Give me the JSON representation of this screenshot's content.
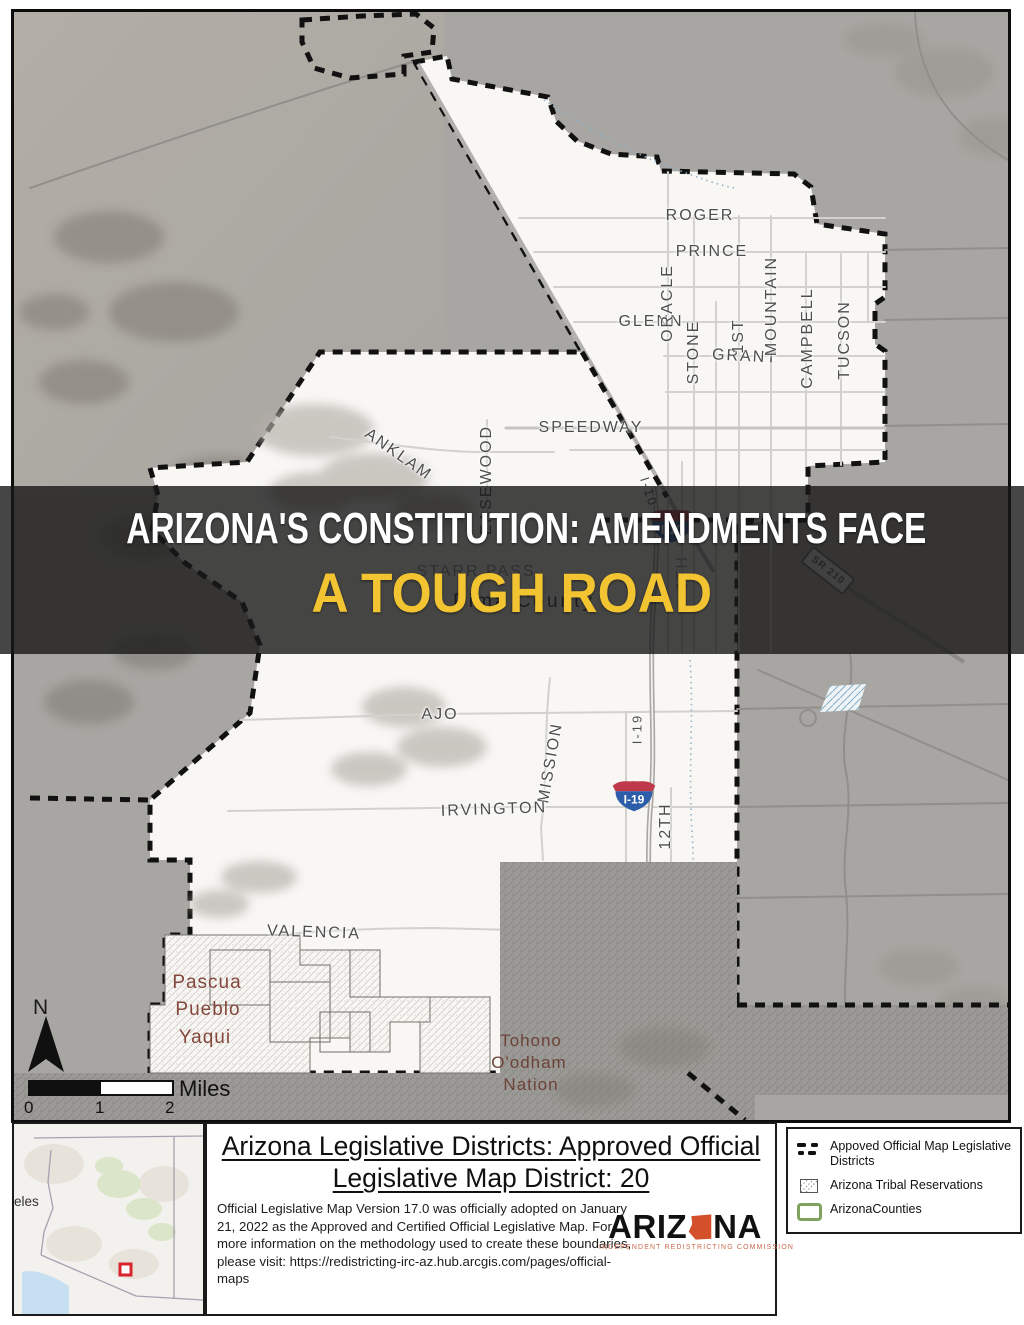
{
  "map": {
    "north": "N",
    "scale": {
      "miles": "Miles",
      "t0": "0",
      "t1": "1",
      "t2": "2"
    },
    "labels": {
      "roger": "ROGER",
      "prince": "PRINCE",
      "glenn": "GLENN",
      "grant": "GRANT",
      "speedway": "SPEEDWAY",
      "oracle": "ORACLE",
      "stone": "STONE",
      "first": "1ST",
      "mountain": "MOUNTAIN",
      "campbell": "CAMPBELL",
      "tucson": "TUCSON",
      "anklam": "ANKLAM",
      "easewood": "EASEWOOD",
      "starr_pass": "STARR  PASS",
      "pima_county": "Pima County",
      "sixth": "6TH",
      "ajo": "AJO",
      "mission": "MISSION",
      "i19_road": "I-19",
      "i10_road": "I-10",
      "irvington": "IRVINGTON",
      "twelfth": "12TH",
      "valencia": "VALENCIA",
      "sr210": "SR 210",
      "pascua1": "Pascua",
      "pascua2": "Pueblo",
      "pascua3": "Yaqui",
      "tohono1": "Tohono",
      "tohono2": "O'odham",
      "tohono3": "Nation"
    },
    "shields": {
      "i10": "I-10",
      "i19": "I-19"
    }
  },
  "banner": {
    "line1": "ARIZONA'S CONSTITUTION: AMENDMENTS FACE",
    "line2": "A TOUGH ROAD"
  },
  "inset": {
    "partial_label": "eles"
  },
  "title_block": {
    "title_line1": "Arizona Legislative Districts: Approved Official",
    "title_line2": "Legislative Map District: 20",
    "body": "Official Legislative Map Version 17.0 was officially adopted on January 21, 2022 as the Approved and Certified Official Legislative Map. For more information on the methodology used to create these boundaries, please visit: https://redistricting-irc-az.hub.arcgis.com/pages/official-maps",
    "logo": {
      "part1": "ARIZ",
      "part2": "NA",
      "subtitle": "INDEPENDENT REDISTRICTING COMMISSION"
    }
  },
  "legend": {
    "item1": "Appoved Official Map Legislative Districts",
    "item2": "Arizona Tribal Reservations",
    "item3": "ArizonaCounties"
  },
  "colors": {
    "banner_bg": "rgba(24,24,24,0.80)",
    "banner_accent": "#F2C431",
    "district_fill": "#F8F7F4",
    "outside_fill": "#A8A6A2",
    "boundary": "#111111",
    "shield_blue": "#2B5DA8",
    "shield_red": "#BE3A4A",
    "logo_orange": "#D4502B",
    "tribal_label": "#84473B",
    "county_green": "#7FA25E"
  }
}
